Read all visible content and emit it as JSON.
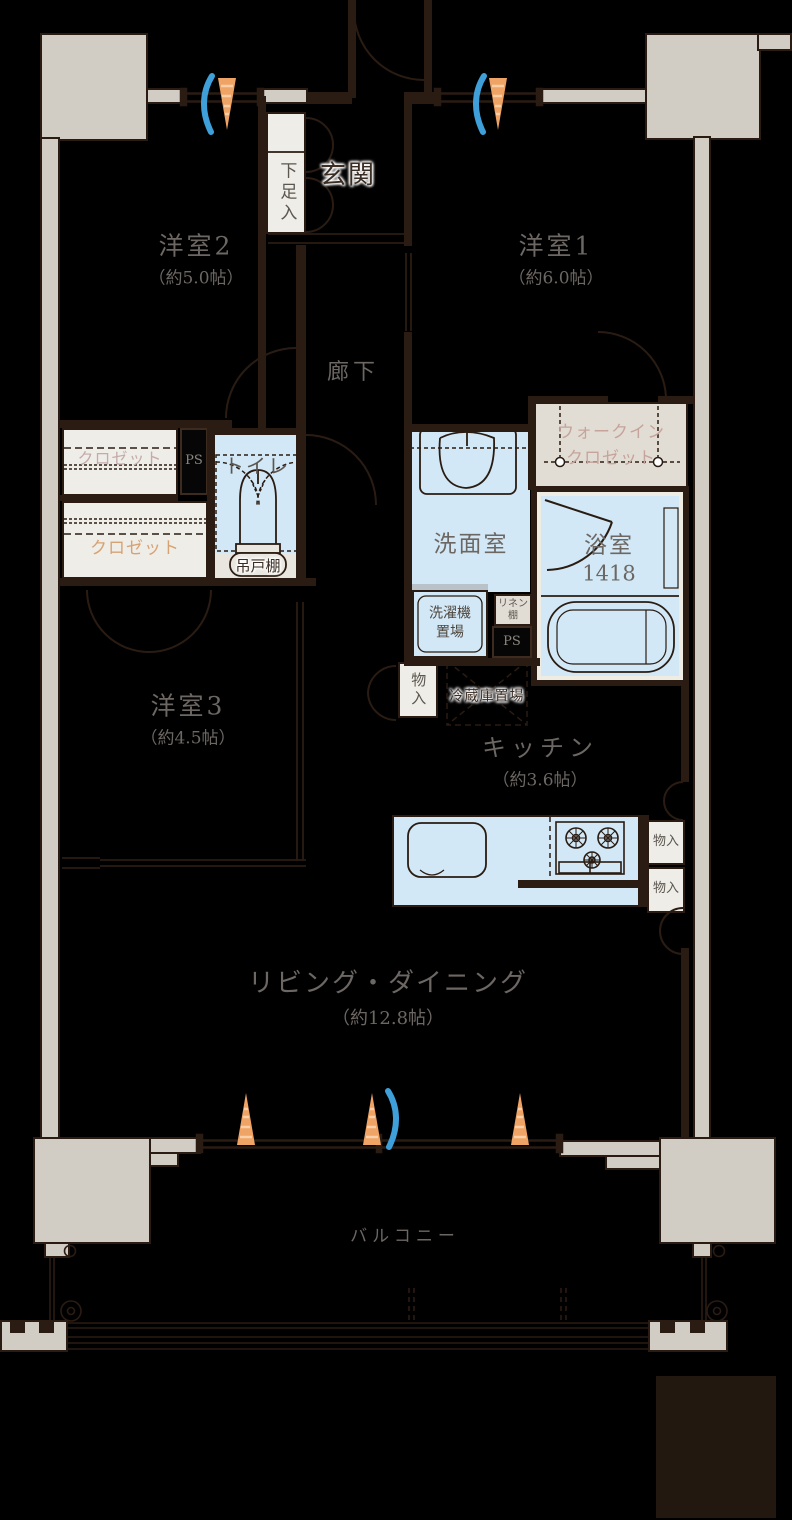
{
  "title": "マンション間取り図",
  "labels": {
    "genkan": "玄関",
    "getabako": "下足入",
    "yoshitsu2": "洋室2",
    "yoshitsu2_size": "（約5.0帖）",
    "yoshitsu1": "洋室1",
    "yoshitsu1_size": "（約6.0帖）",
    "rouka": "廊下",
    "closet_a": "クロゼット",
    "closet_b": "クロゼット",
    "ps1": "PS",
    "ps2": "PS",
    "toilet": "トイレ",
    "tsuritodana": "吊戸棚",
    "senmen": "洗面室",
    "bath": "浴室",
    "bath_size": "1418",
    "wic_line1": "ウォークイン",
    "wic_line2": "クロゼット",
    "washer_line1": "洗濯機",
    "washer_line2": "置場",
    "linen_line1": "リネン",
    "linen_line2": "棚",
    "monoire_hall": "物入",
    "monoire_k1": "物入",
    "monoire_k2": "物入",
    "fridge": "冷蔵庫置場",
    "kitchen": "キッチン",
    "kitchen_size": "（約3.6帖）",
    "yoshitsu3": "洋室3",
    "yoshitsu3_size": "（約4.5帖）",
    "living": "リビング・ダイニング",
    "living_size": "（約12.8帖）",
    "balcony": "バルコニー"
  },
  "colors": {
    "wall": "#2a1c12",
    "concrete": "#d2cdc4",
    "water": "#d2e8f6",
    "box": "#efede7",
    "beige": "#e2ddd4",
    "beige2": "#e9e6df",
    "text": "#6c6763",
    "pink": "#c6a49c",
    "orange": "#d7a273",
    "cone": "#efa465",
    "airflow": "#3e9fd9",
    "bg": "#000000"
  }
}
